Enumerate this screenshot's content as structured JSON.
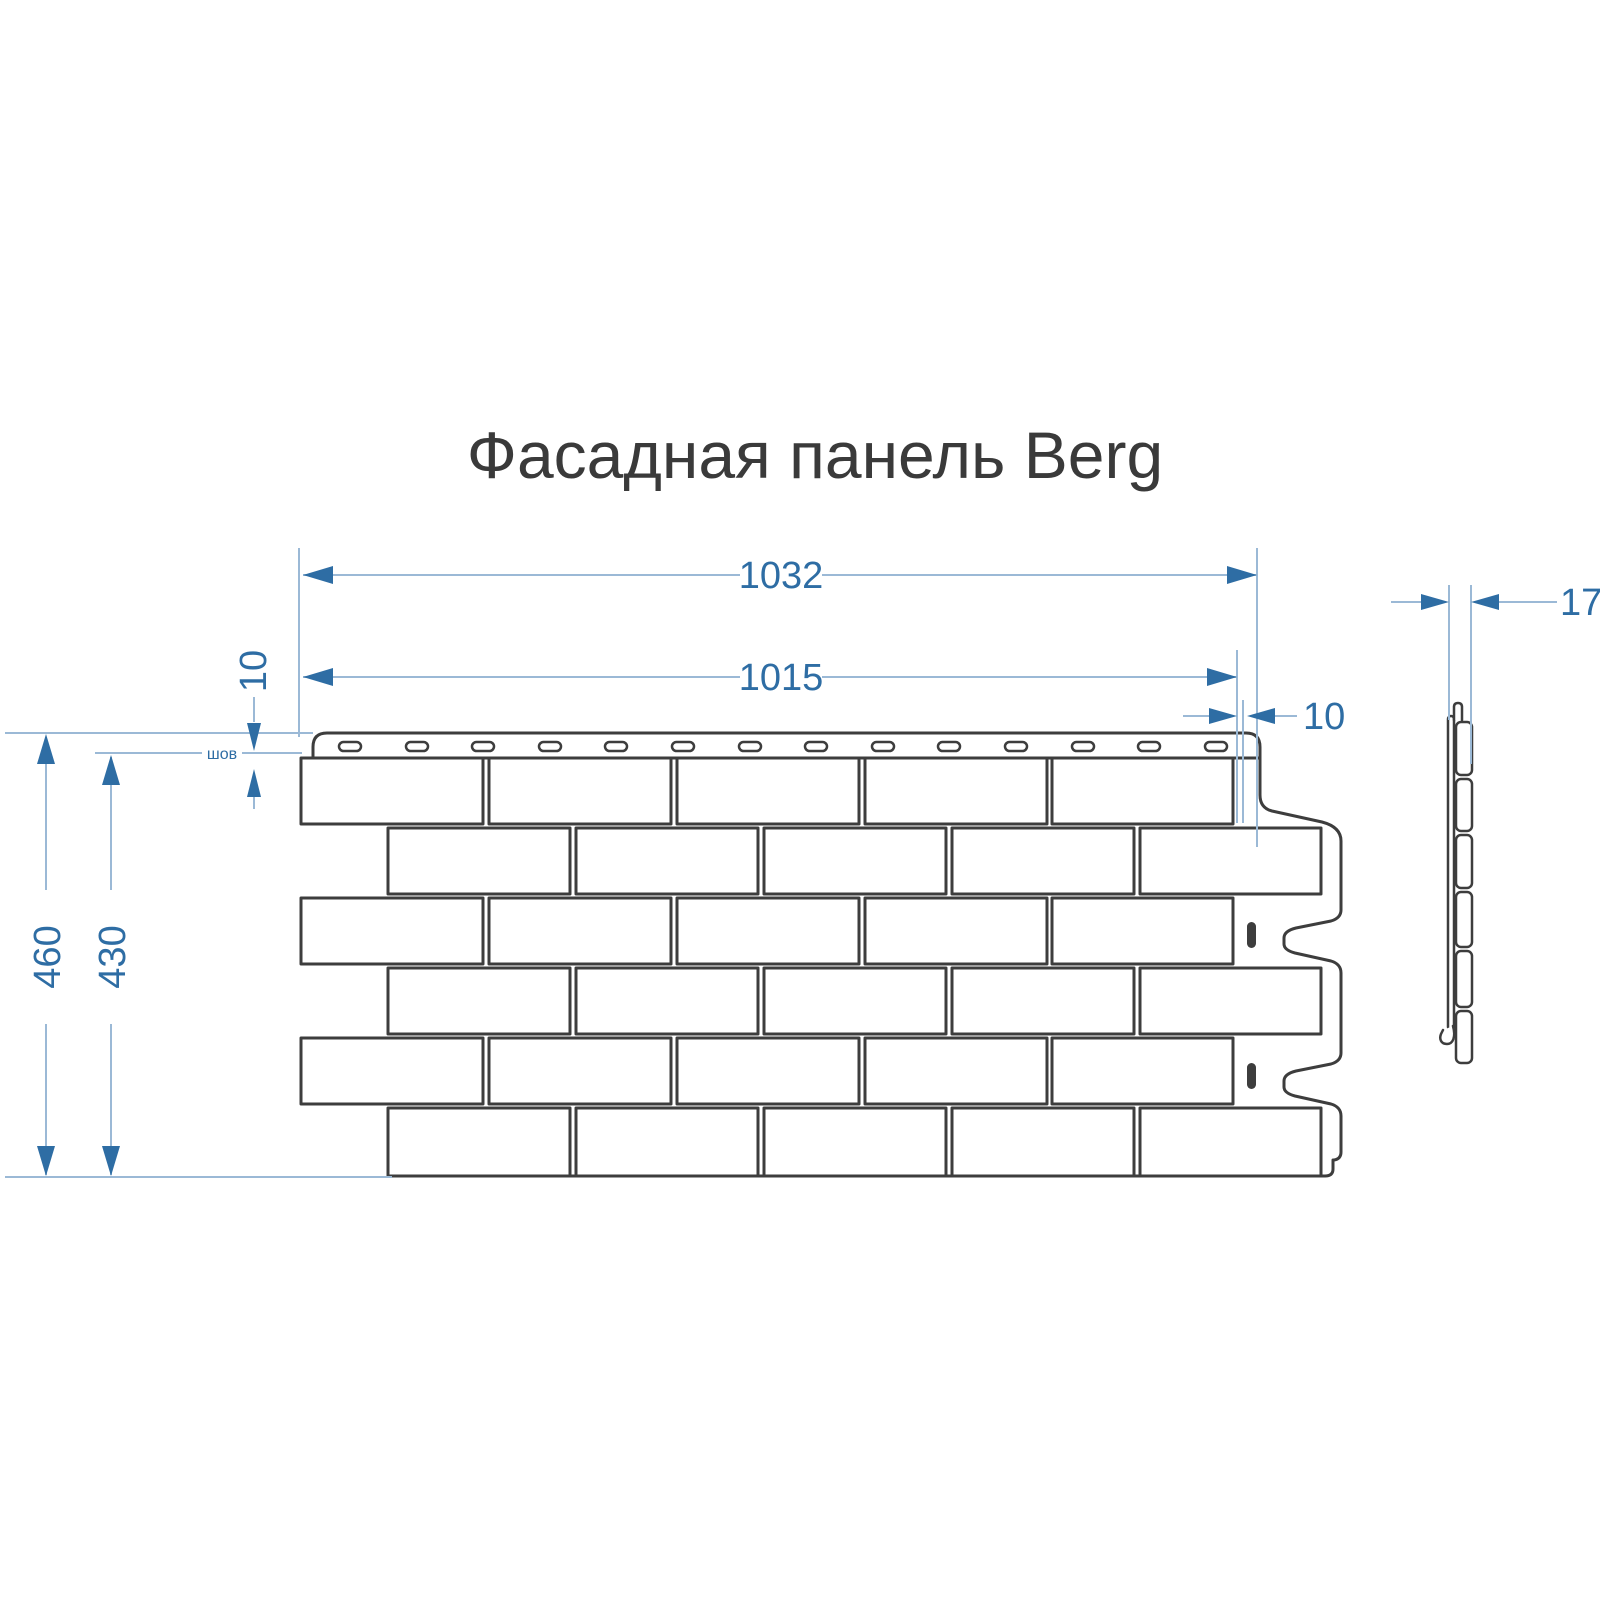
{
  "title": "Фасадная панель Berg",
  "dimensions": {
    "overall_width": "1032",
    "panel_width": "1015",
    "edge_offset": "10",
    "seam_height": "10",
    "seam_label": "шов",
    "overall_height": "460",
    "brick_area_height": "430",
    "thickness": "17"
  },
  "colors": {
    "dimension_accent": "#2e6da4",
    "dimension_line": "#9bb9d6",
    "drawing_outline": "#3d3d3d",
    "background": "#ffffff"
  }
}
